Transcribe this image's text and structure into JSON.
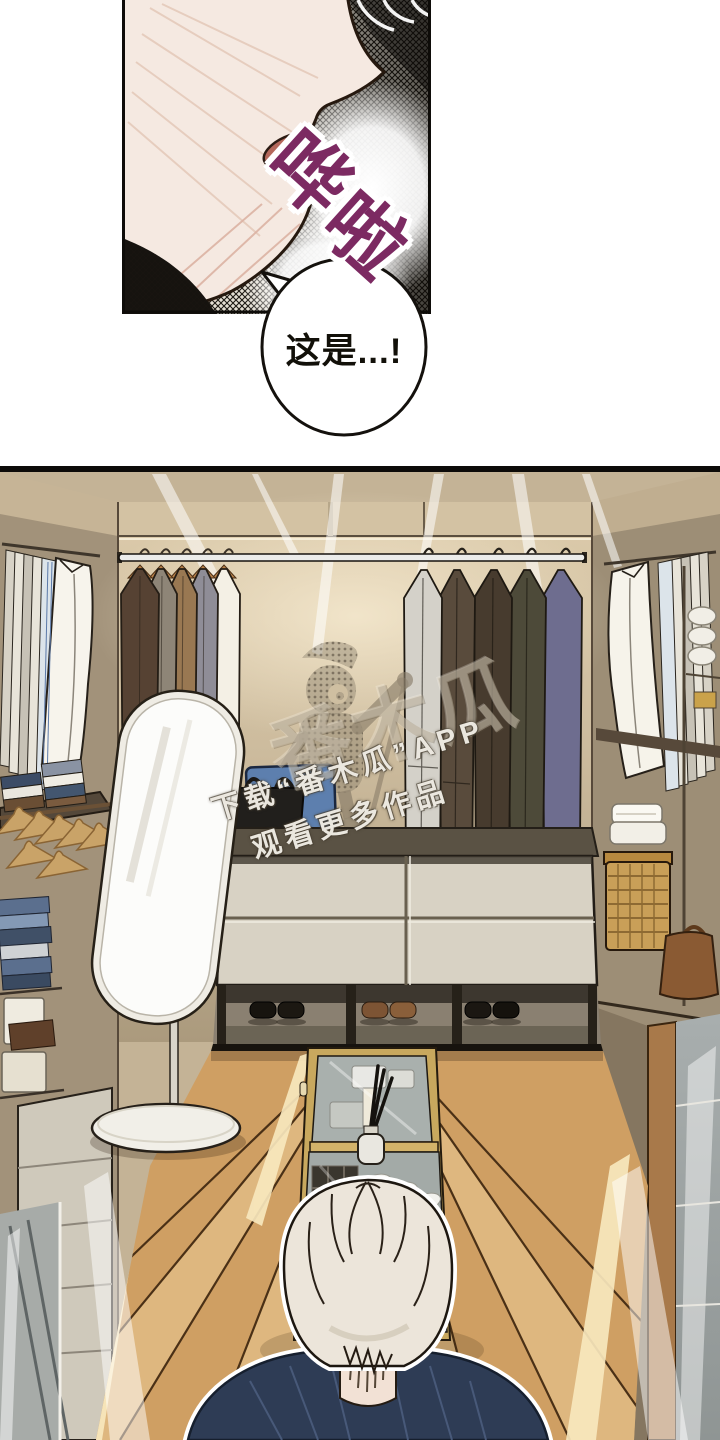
{
  "page": {
    "kind": "webtoon comic page",
    "background": "#ffffff"
  },
  "panel1": {
    "sfx": {
      "char1": "哗",
      "char2": "啦",
      "color": "#7c2a62"
    },
    "speech_bubble": {
      "text": "这是...!",
      "text_color": "#121009",
      "fill": "#ffffff",
      "border": "#14110d"
    }
  },
  "watermark": {
    "logo_text": "番木瓜",
    "line1": "下载“番木瓜”APP",
    "line2": "观看更多作品",
    "text_color": "#f8f5ee"
  },
  "scene": {
    "palette": {
      "floor_wood": "#cf9f63",
      "floor_plank_light": "#deb77f",
      "back_wall_top": "#dccbab",
      "back_wall_bottom": "#ab9a7d",
      "rod": "#ececea",
      "mirror_frame": "#efece4",
      "island_frame": "#c8a85e",
      "person_shirt": "#2e3c55",
      "drawer_front": "#d8d2c4"
    },
    "left_garments": [
      "#f4f0e5",
      "#8f8d97",
      "#997852",
      "#8e8577",
      "#564233"
    ],
    "right_garments": [
      "#6e6d8f",
      "#4d4a39",
      "#473b2e",
      "#594b3c",
      "#d4d1c9"
    ]
  }
}
